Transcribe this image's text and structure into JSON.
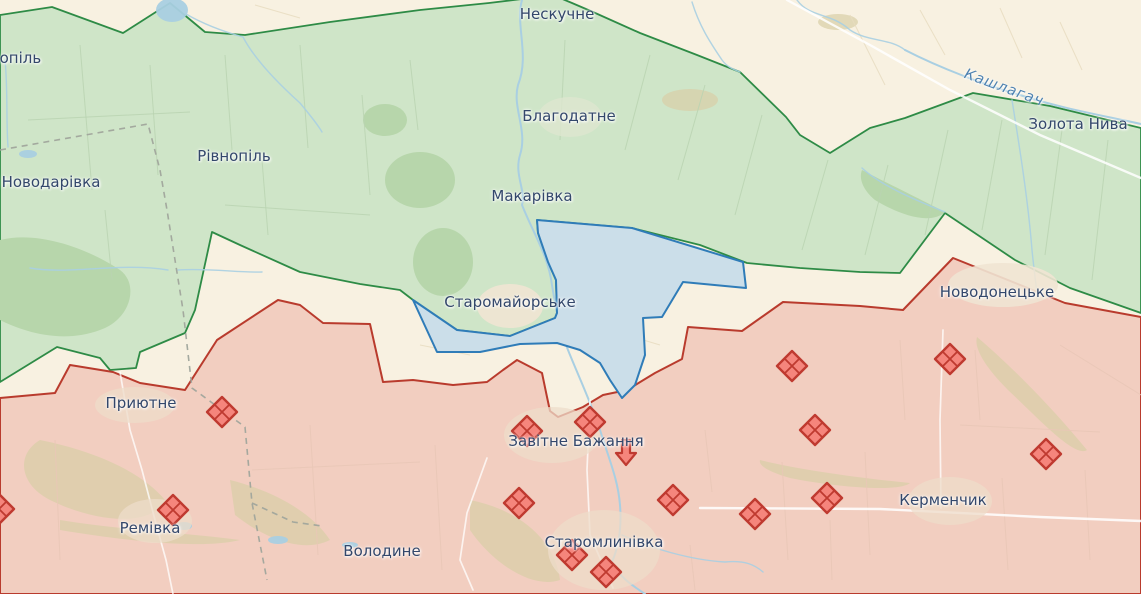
{
  "map": {
    "colors": {
      "liberated_fill": "#cfe5c8",
      "liberated_stroke": "#2e8b46",
      "occupied_fill": "#f2cec0",
      "occupied_stroke": "#b93b2d",
      "advance_fill": "#cbdee9",
      "advance_stroke": "#2f7cb8",
      "neutral_fill": "#f8f1e1",
      "marker_fill": "#f5857c",
      "marker_stroke": "#bf3a30",
      "water": "#a9cfe2",
      "road": "#ffffff",
      "label_color": "#33476b",
      "river_label_color": "#4e82b0"
    },
    "labels": [
      {
        "text": "Нескучне",
        "x": 557,
        "y": 14,
        "kind": "town"
      },
      {
        "text": "Благодатне",
        "x": 569,
        "y": 116,
        "kind": "town"
      },
      {
        "text": "Макарівка",
        "x": 532,
        "y": 196,
        "kind": "town"
      },
      {
        "text": "Рівнопіль",
        "x": 234,
        "y": 156,
        "kind": "town"
      },
      {
        "text": "Новодарівка",
        "x": 51,
        "y": 182,
        "kind": "town"
      },
      {
        "text": "вопіль",
        "x": 16,
        "y": 58,
        "kind": "town"
      },
      {
        "text": "Золота Нива",
        "x": 1078,
        "y": 124,
        "kind": "town"
      },
      {
        "text": "Новодонецьке",
        "x": 997,
        "y": 292,
        "kind": "town"
      },
      {
        "text": "Старомайорське",
        "x": 510,
        "y": 302,
        "kind": "town"
      },
      {
        "text": "Приютне",
        "x": 141,
        "y": 403,
        "kind": "town"
      },
      {
        "text": "Завітне Бажання",
        "x": 576,
        "y": 441,
        "kind": "town"
      },
      {
        "text": "Ремівка",
        "x": 150,
        "y": 528,
        "kind": "town"
      },
      {
        "text": "Володине",
        "x": 382,
        "y": 551,
        "kind": "town"
      },
      {
        "text": "Старомлинівка",
        "x": 604,
        "y": 542,
        "kind": "town"
      },
      {
        "text": "Керменчик",
        "x": 943,
        "y": 500,
        "kind": "town"
      },
      {
        "text": "Кашлагач",
        "x": 1004,
        "y": 88,
        "kind": "river",
        "angle": 20
      }
    ],
    "fortification_markers": [
      {
        "x": 222,
        "y": 412
      },
      {
        "x": 173,
        "y": 510
      },
      {
        "x": -1,
        "y": 509
      },
      {
        "x": 527,
        "y": 431
      },
      {
        "x": 590,
        "y": 422
      },
      {
        "x": 519,
        "y": 503
      },
      {
        "x": 572,
        "y": 555
      },
      {
        "x": 606,
        "y": 572
      },
      {
        "x": 673,
        "y": 500
      },
      {
        "x": 755,
        "y": 514
      },
      {
        "x": 792,
        "y": 366
      },
      {
        "x": 815,
        "y": 430
      },
      {
        "x": 827,
        "y": 498
      },
      {
        "x": 950,
        "y": 359
      },
      {
        "x": 1046,
        "y": 454
      }
    ],
    "attack_arrow": {
      "x": 626,
      "y": 452,
      "direction": "down"
    }
  }
}
